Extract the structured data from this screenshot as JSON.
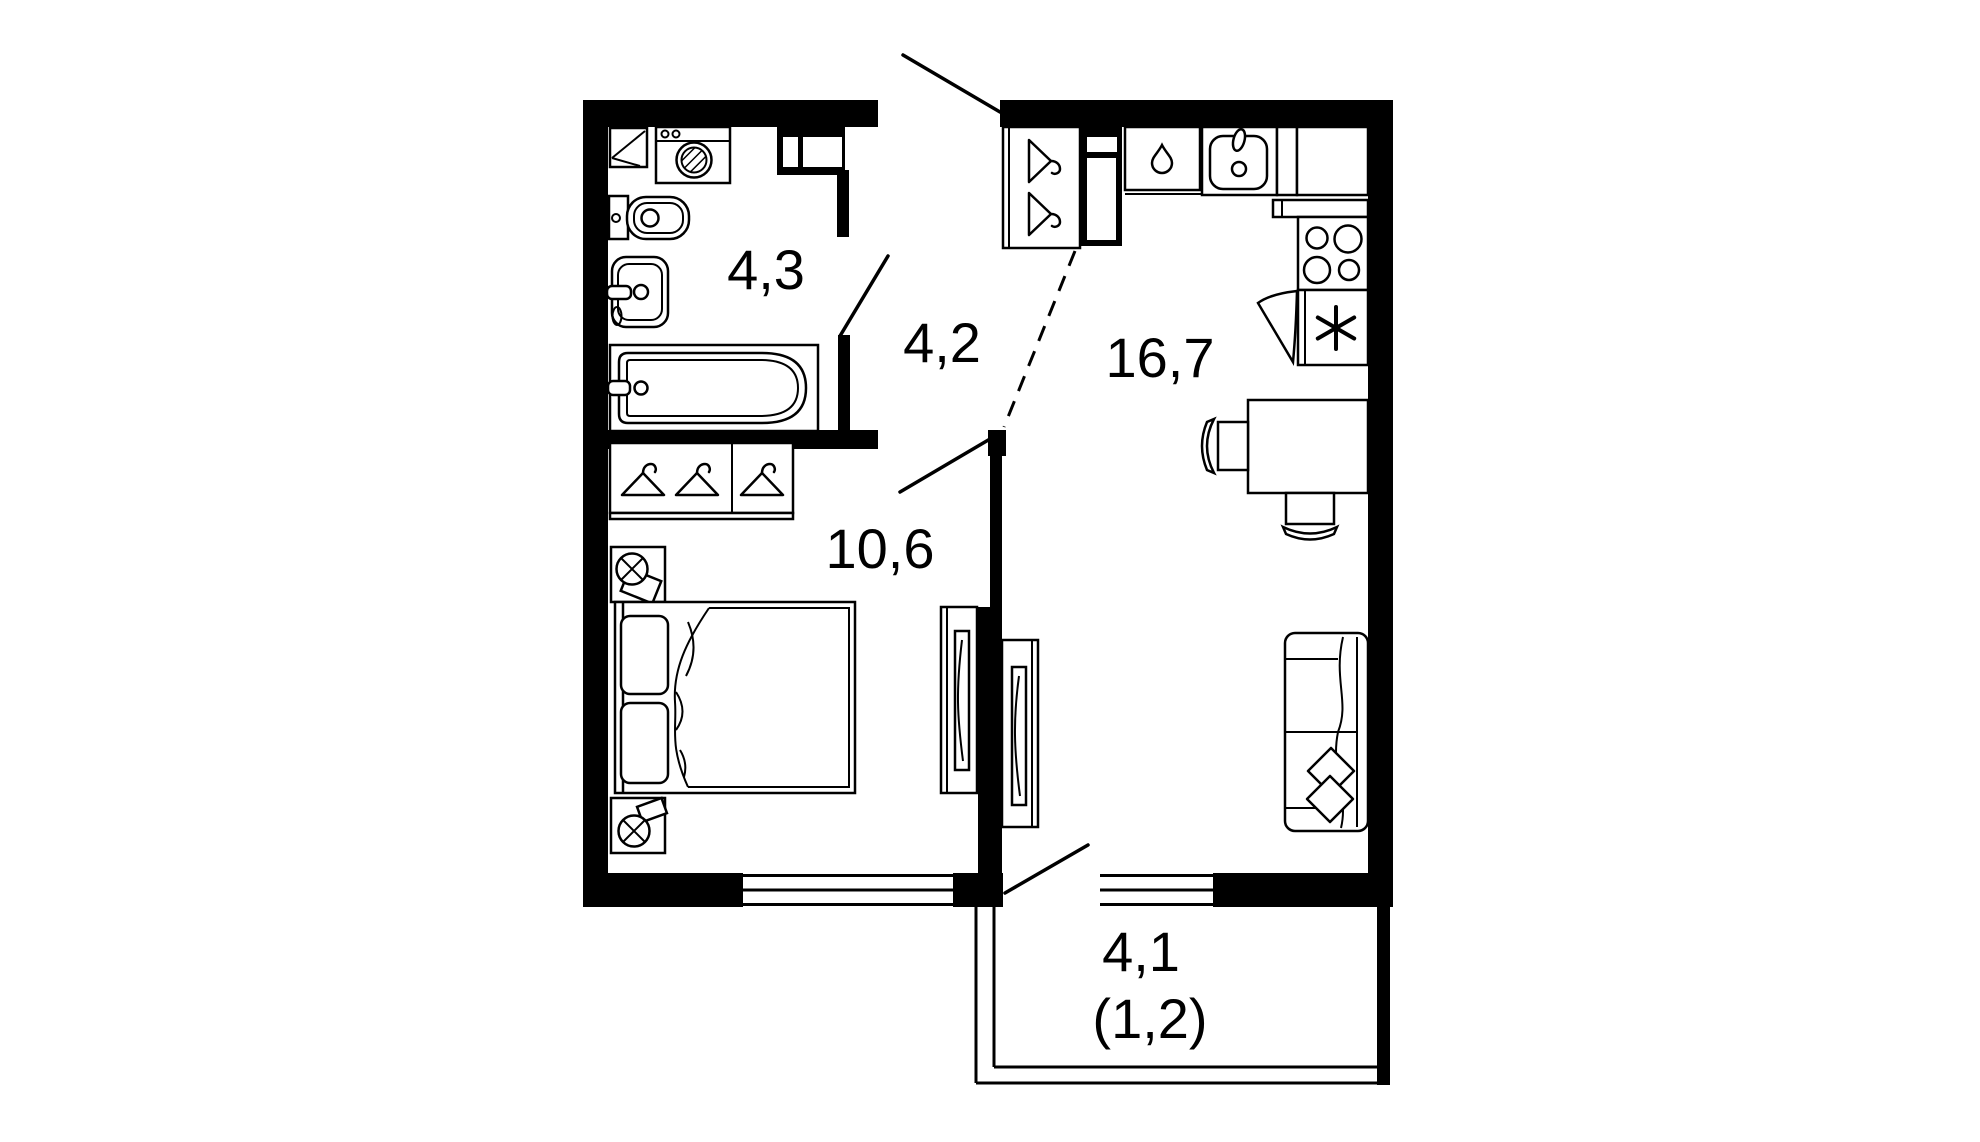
{
  "plan": {
    "type": "apartment-floor-plan",
    "colors": {
      "background": "#ffffff",
      "walls": "#000000",
      "furniture_outline": "#000000"
    }
  },
  "rooms": {
    "bathroom": {
      "area": "4,3"
    },
    "hallway": {
      "area": "4,2"
    },
    "bedroom": {
      "area": "10,6"
    },
    "kitchen_living": {
      "area": "16,7"
    },
    "balcony": {
      "area": "4,1",
      "area_secondary": "(1,2)"
    }
  },
  "furniture_icons": [
    "washing-machine-icon",
    "shelf-icon",
    "toilet-icon",
    "washbasin-icon",
    "bathtub-icon",
    "hanger-icon",
    "wardrobe-icon",
    "nightstand-lamp-icon",
    "double-bed-icon",
    "tv-unit-icon",
    "entry-closet-icon",
    "vent-shaft-icon",
    "dishwasher-drop-icon",
    "kitchen-sink-icon",
    "stove-icon",
    "fridge-icon",
    "dining-table-icon",
    "chair-icon",
    "sofa-icon",
    "pillow-icon",
    "door-swing-icon",
    "window-icon"
  ]
}
